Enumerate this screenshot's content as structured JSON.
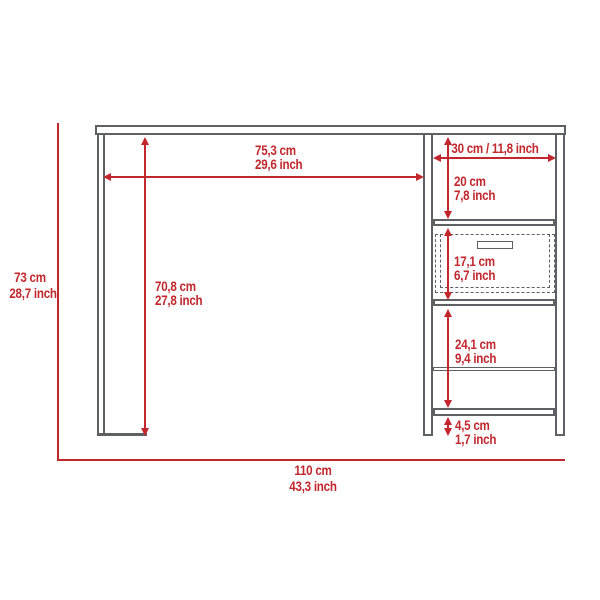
{
  "diagram": {
    "kind": "furniture-dimension-drawing",
    "subject": "desk with left side panel and right shelving column with drawer",
    "accent_color": "#c1272d",
    "line_color": "#5f6063",
    "background": "#ffffff"
  },
  "dimensions": {
    "desktop_clear_width": {
      "cm": "75,3 cm",
      "inch": "29,6 inch"
    },
    "side_unit_width": {
      "combined": "30 cm / 11,8 inch"
    },
    "top_cubby_height": {
      "cm": "20 cm",
      "inch": "7,8 inch"
    },
    "drawer_height": {
      "cm": "17,1 cm",
      "inch": "6,7 inch"
    },
    "knee_space_height": {
      "cm": "70,8 cm",
      "inch": "27,8 inch"
    },
    "lower_cubby_height": {
      "cm": "24,1 cm",
      "inch": "9,4 inch"
    },
    "foot_clearance": {
      "cm": "4,5 cm",
      "inch": "1,7 inch"
    },
    "overall_height": {
      "cm": "73 cm",
      "inch": "28,7 inch"
    },
    "overall_width": {
      "cm": "110 cm",
      "inch": "43,3 inch"
    }
  }
}
